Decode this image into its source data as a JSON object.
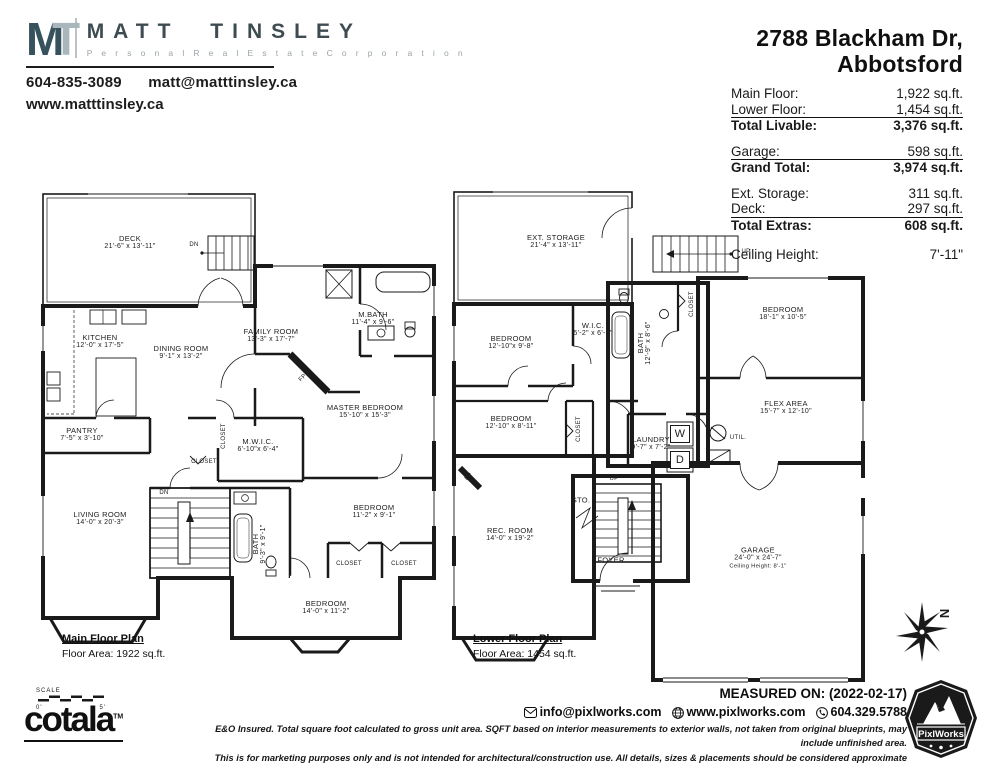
{
  "agent": {
    "logo_m": "M",
    "logo_t": "T",
    "name": "MATT TINSLEY",
    "tagline": "P e r s o n a l   R e a l   E s t a t e   C o r p o r a t i o n",
    "phone": "604-835-3089",
    "email": "matt@matttinsley.ca",
    "website": "www.matttinsley.ca"
  },
  "property": {
    "address_line1": "2788 Blackham Dr,",
    "address_line2": "Abbotsford",
    "summary_groups": [
      {
        "rows": [
          {
            "label": "Main Floor:",
            "value": "1,922 sq.ft."
          },
          {
            "label": "Lower Floor:",
            "value": "1,454 sq.ft."
          }
        ],
        "total": {
          "label": "Total Livable:",
          "value": "3,376 sq.ft."
        }
      },
      {
        "rows": [
          {
            "label": "Garage:",
            "value": "598 sq.ft."
          }
        ],
        "total": {
          "label": "Grand Total:",
          "value": "3,974 sq.ft."
        }
      },
      {
        "rows": [
          {
            "label": "Ext. Storage:",
            "value": "311 sq.ft."
          },
          {
            "label": "Deck:",
            "value": "297 sq.ft."
          }
        ],
        "total": {
          "label": "Total Extras:",
          "value": "608 sq.ft."
        }
      }
    ],
    "ceiling_height": {
      "label": "Ceiling Height:",
      "value": "7'-11\""
    }
  },
  "main_floor": {
    "title": "Main Floor Plan",
    "area_note": "Floor Area: 1922 sq.ft.",
    "rooms": [
      {
        "name": "DECK",
        "dims": "21'-6\" x 13'-11\"",
        "x": 92,
        "y": 57
      },
      {
        "name": "KITCHEN",
        "dims": "12'-0\" x 17'-5\"",
        "x": 62,
        "y": 156
      },
      {
        "name": "DINING ROOM",
        "dims": "9'-1\" x 13'-2\"",
        "x": 143,
        "y": 167
      },
      {
        "name": "FAMILY ROOM",
        "dims": "13'-3\" x 17'-7\"",
        "x": 233,
        "y": 150
      },
      {
        "name": "M.BATH",
        "dims": "11'-4\" x 9'-6\"",
        "x": 335,
        "y": 133
      },
      {
        "name": "MASTER BEDROOM",
        "dims": "15'-10\" x 15'-3\"",
        "x": 327,
        "y": 226
      },
      {
        "name": "PANTRY",
        "dims": "7'-5\" x 3'-10\"",
        "x": 44,
        "y": 249
      },
      {
        "name": "M.W.I.C.",
        "dims": "6'-10\"x 6'-4\"",
        "x": 220,
        "y": 260
      },
      {
        "name": "LIVING ROOM",
        "dims": "14'-0\" x 20'-3\"",
        "x": 62,
        "y": 333
      },
      {
        "name": "BATH",
        "dims": "9'-3\" x 9'-1\"",
        "x": 222,
        "y": 358,
        "vertical": true
      },
      {
        "name": "BEDROOM",
        "dims": "11'-2\" x 9'-1\"",
        "x": 336,
        "y": 326
      },
      {
        "name": "BEDROOM",
        "dims": "14'-0\" x 11'-2\"",
        "x": 288,
        "y": 422
      }
    ],
    "marks": [
      {
        "text": "DN",
        "x": 156,
        "y": 59
      },
      {
        "text": "DN",
        "x": 126,
        "y": 307
      },
      {
        "text": "CLOSET",
        "x": 166,
        "y": 276
      },
      {
        "text": "CLOSET",
        "x": 186,
        "y": 250,
        "vertical": true
      },
      {
        "text": "CLOSET",
        "x": 311,
        "y": 378
      },
      {
        "text": "CLOSET",
        "x": 366,
        "y": 378
      },
      {
        "text": "FP",
        "x": 265,
        "y": 192,
        "diag": true
      }
    ]
  },
  "lower_floor": {
    "title": "Lower Floor Plan",
    "area_note": "Floor Area: 1454 sq.ft.",
    "rooms": [
      {
        "name": "EXT. STORAGE",
        "dims": "21'-4\" x 13'-11\"",
        "x": 108,
        "y": 56
      },
      {
        "name": "BEDROOM",
        "dims": "12'-10\"x 9'-8\"",
        "x": 63,
        "y": 157
      },
      {
        "name": "W.I.C.",
        "dims": "5'-2\" x 6'-3\"",
        "x": 145,
        "y": 144
      },
      {
        "name": "BATH",
        "dims": "12'-9\" x 8'-6\"",
        "x": 197,
        "y": 157,
        "vertical": true
      },
      {
        "name": "BEDROOM",
        "dims": "18'-1\" x 10'-5\"",
        "x": 335,
        "y": 128
      },
      {
        "name": "FLEX AREA",
        "dims": "15'-7\" x 12'-10\"",
        "x": 338,
        "y": 222
      },
      {
        "name": "LAUNDRY",
        "dims": "9'-7\" x 7'-2\"",
        "x": 203,
        "y": 258
      },
      {
        "name": "BEDROOM",
        "dims": "12'-10\" x 8'-11\"",
        "x": 63,
        "y": 237
      },
      {
        "name": "REC. ROOM",
        "dims": "14'-0\" x 19'-2\"",
        "x": 62,
        "y": 349
      },
      {
        "name": "GARAGE",
        "dims": "24'-0\" x 24'-7\"",
        "extra": "Ceiling Height: 8'-1\"",
        "x": 310,
        "y": 372
      },
      {
        "name": "FOYER",
        "dims": "",
        "x": 163,
        "y": 374
      },
      {
        "name": "STO.",
        "dims": "",
        "x": 133,
        "y": 314
      }
    ],
    "marks": [
      {
        "text": "UP",
        "x": 298,
        "y": 66
      },
      {
        "text": "UP",
        "x": 166,
        "y": 293
      },
      {
        "text": "CLOSET",
        "x": 244,
        "y": 118,
        "vertical": true
      },
      {
        "text": "CLOSET",
        "x": 131,
        "y": 243,
        "vertical": true
      },
      {
        "text": "W",
        "x": 232,
        "y": 248,
        "box": true
      },
      {
        "text": "D",
        "x": 232,
        "y": 274,
        "box": true
      },
      {
        "text": "UTIL.",
        "x": 290,
        "y": 252
      },
      {
        "text": "FP",
        "x": 21,
        "y": 291,
        "diag": true
      }
    ]
  },
  "compass": {
    "letter": "N"
  },
  "footer": {
    "scale_label": "SCALE",
    "scale_start": "0'",
    "scale_end": "5'",
    "brand": "cotala",
    "brand_tm": "TM",
    "measured_on": "MEASURED ON: (2022-02-17)",
    "contact_email": "info@pixlworks.com",
    "contact_website": "www.pixlworks.com",
    "contact_phone": "604.329.5788",
    "disclaimer_line1": "E&O Insured.  Total square foot calculated to gross unit area. SQFT based on interior measurements to exterior walls, not taken from original blueprints, may include unfinished area.",
    "disclaimer_line2": "This is for marketing purposes only and is not intended for architectural/construction use.  All details, sizes & placements should be considered approximate within +/- 2%  tolerance.",
    "vendor_badge": "PixlWorks"
  }
}
